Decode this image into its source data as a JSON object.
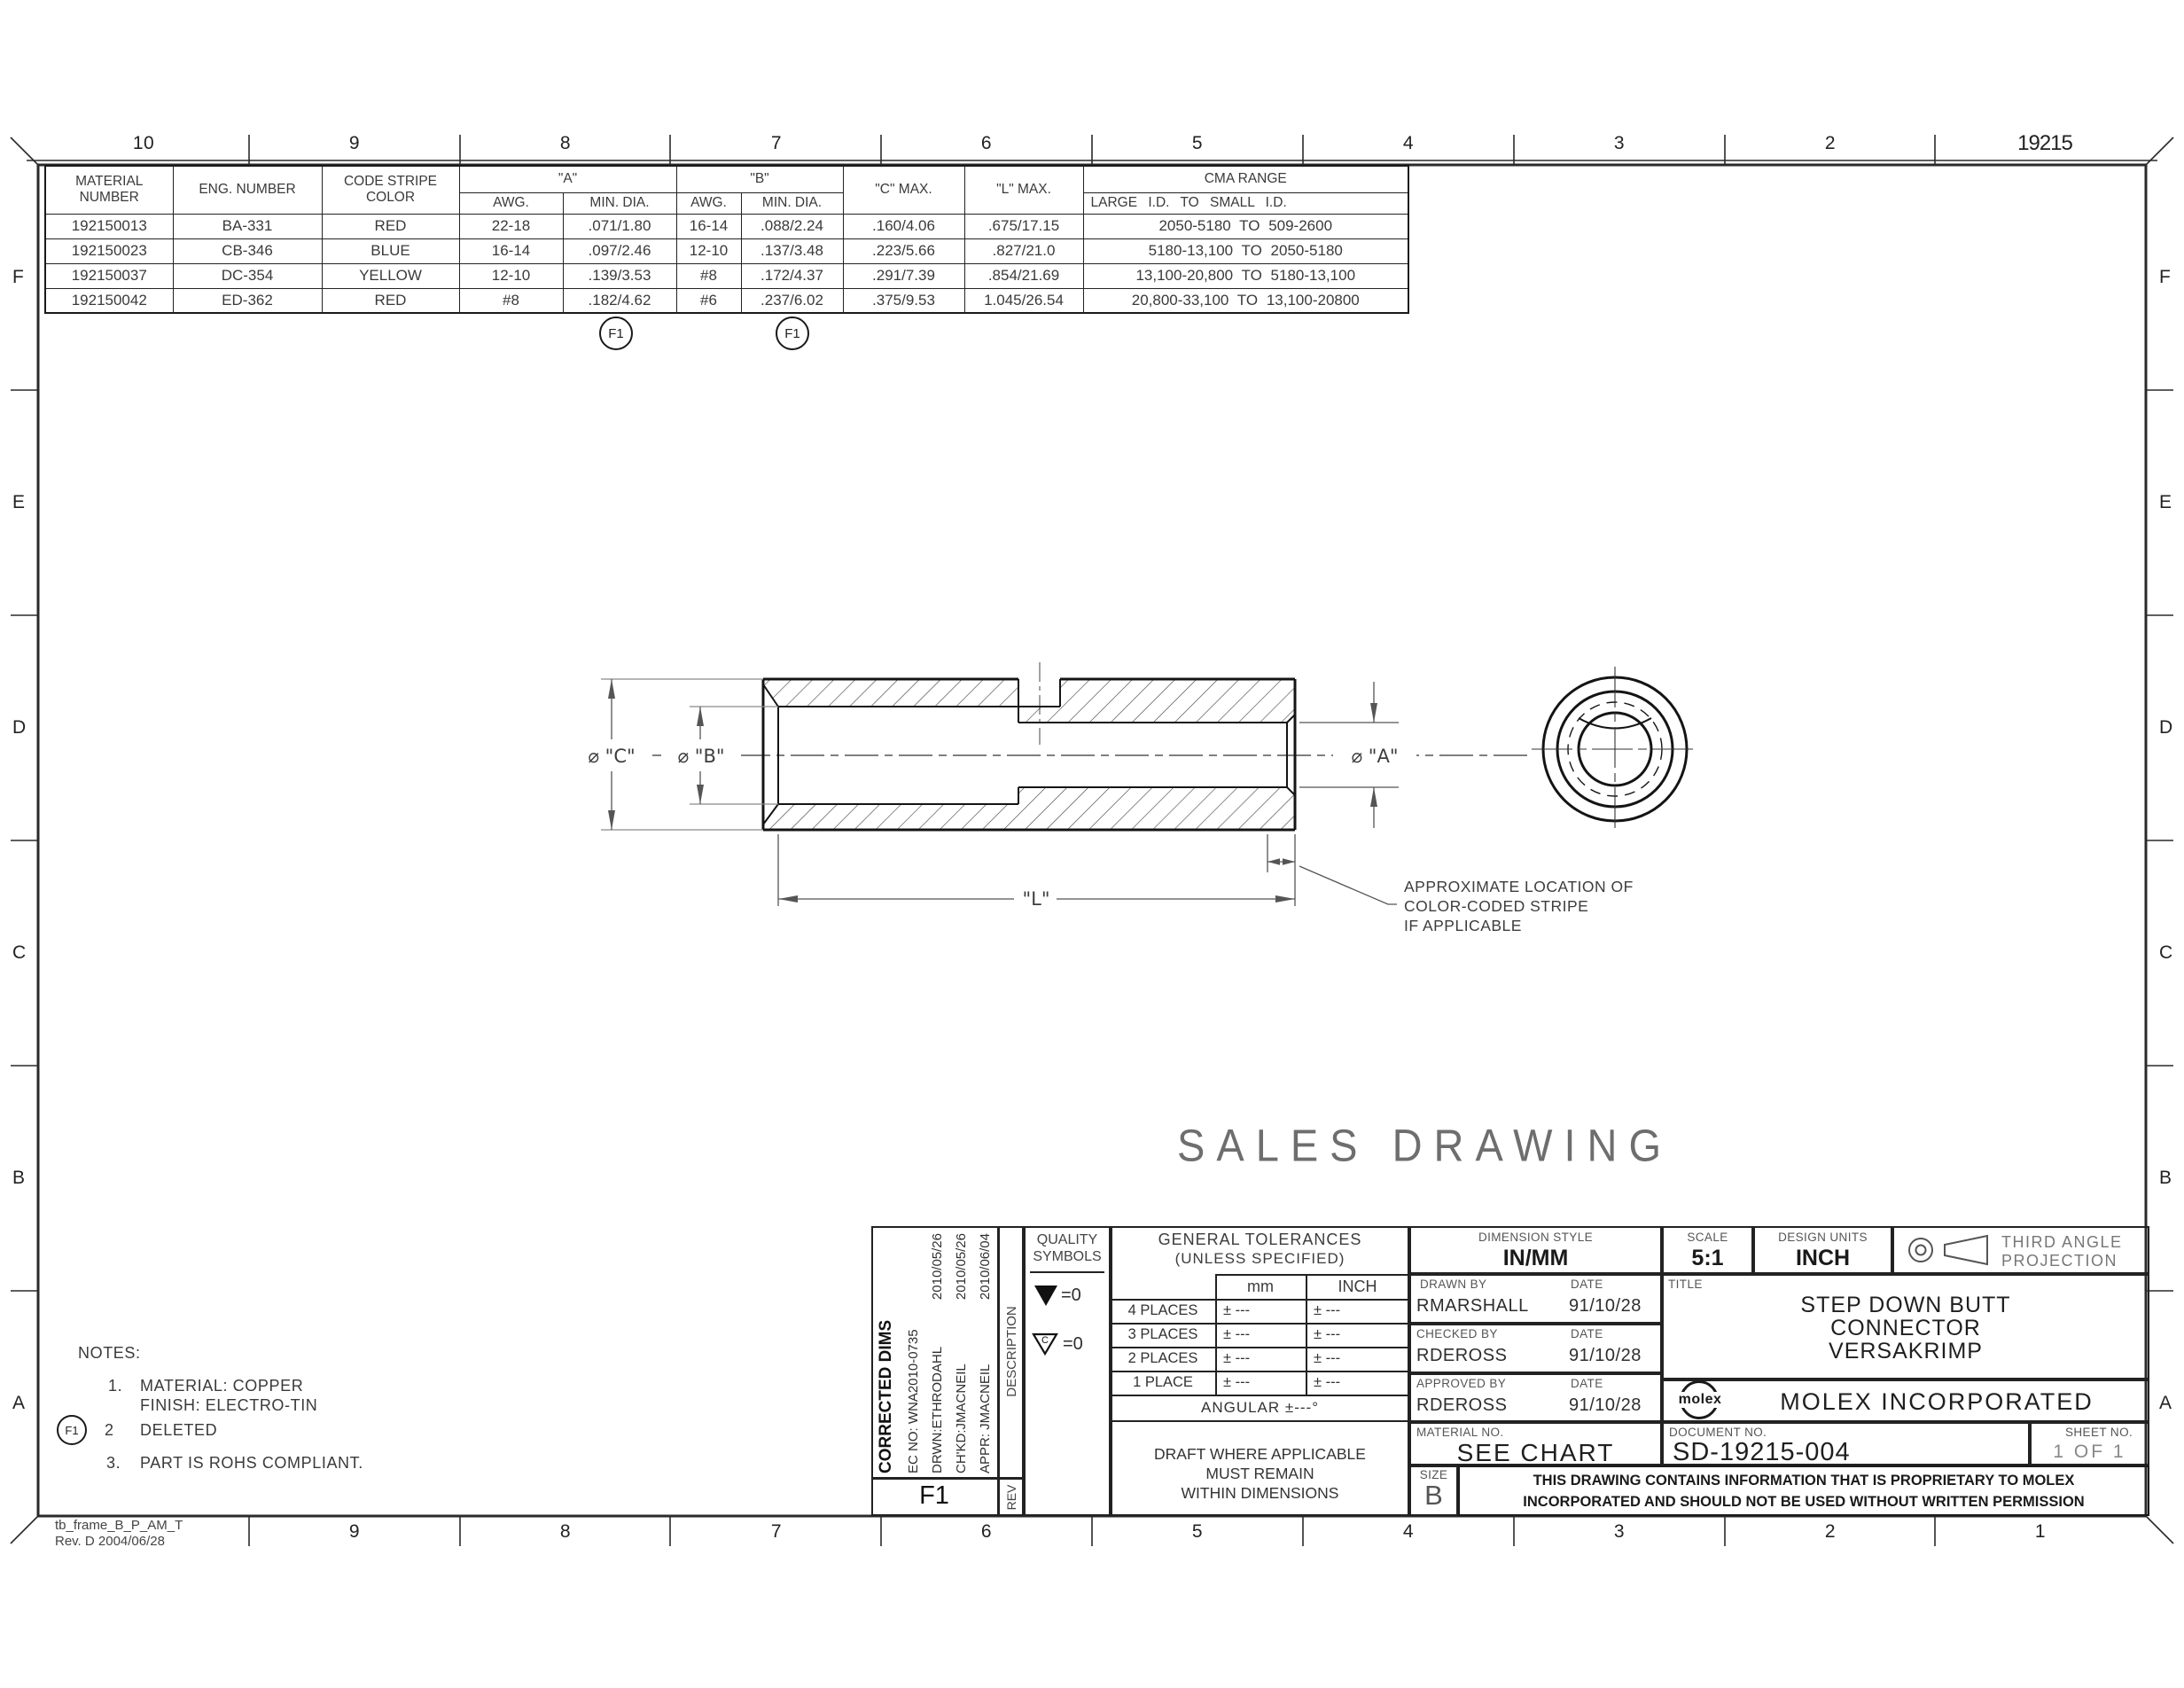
{
  "sheet": {
    "frame_id_line1": "tb_frame_B_P_AM_T",
    "frame_id_line2": "Rev. D 2004/06/28"
  },
  "zones": {
    "top": [
      "10",
      "9",
      "8",
      "7",
      "6",
      "5",
      "4",
      "3",
      "2",
      "19215"
    ],
    "bottom": [
      "9",
      "8",
      "7",
      "6",
      "5",
      "4",
      "3",
      "2",
      "1"
    ],
    "left": [
      "F",
      "E",
      "D",
      "C",
      "B",
      "A"
    ],
    "right": [
      "F",
      "E",
      "D",
      "C",
      "B",
      "A"
    ]
  },
  "spec_table": {
    "headers": {
      "material": "MATERIAL NUMBER",
      "eng": "ENG. NUMBER",
      "stripe": "CODE STRIPE COLOR",
      "a": "\"A\"",
      "b": "\"B\"",
      "awg": "AWG.",
      "min_dia": "MIN. DIA.",
      "c_max": "\"C\" MAX.",
      "l_max": "\"L\" MAX.",
      "cma": "CMA RANGE",
      "cma_sub": "LARGE I.D. TO SMALL I.D."
    },
    "rows": [
      {
        "material": "192150013",
        "eng": "BA-331",
        "stripe": "RED",
        "a_awg": "22-18",
        "a_min": ".071/1.80",
        "b_awg": "16-14",
        "b_min": ".088/2.24",
        "c_max": ".160/4.06",
        "l_max": ".675/17.15",
        "cma": "2050-5180 TO 509-2600"
      },
      {
        "material": "192150023",
        "eng": "CB-346",
        "stripe": "BLUE",
        "a_awg": "16-14",
        "a_min": ".097/2.46",
        "b_awg": "12-10",
        "b_min": ".137/3.48",
        "c_max": ".223/5.66",
        "l_max": ".827/21.0",
        "cma": "5180-13,100 TO 2050-5180"
      },
      {
        "material": "192150037",
        "eng": "DC-354",
        "stripe": "YELLOW",
        "a_awg": "12-10",
        "a_min": ".139/3.53",
        "b_awg": "#8",
        "b_min": ".172/4.37",
        "c_max": ".291/7.39",
        "l_max": ".854/21.69",
        "cma": "13,100-20,800 TO 5180-13,100"
      },
      {
        "material": "192150042",
        "eng": "ED-362",
        "stripe": "RED",
        "a_awg": "#8",
        "a_min": ".182/4.62",
        "b_awg": "#6",
        "b_min": ".237/6.02",
        "c_max": ".375/9.53",
        "l_max": "1.045/26.54",
        "cma": "20,800-33,100 TO 13,100-20800"
      }
    ],
    "flag_a": "F1",
    "flag_b": "F1"
  },
  "drawing": {
    "dim_c": "⌀ \"C\"",
    "dim_b": "⌀ \"B\"",
    "dim_a": "⌀ \"A\"",
    "dim_l": "\"L\"",
    "stripe_note_line1": "APPROXIMATE LOCATION OF",
    "stripe_note_line2": "COLOR-CODED STRIPE",
    "stripe_note_line3": "IF APPLICABLE"
  },
  "watermark": "SALES DRAWING",
  "notes": {
    "title": "NOTES:",
    "n1_num": "1.",
    "n1_line1": "MATERIAL: COPPER",
    "n1_line2": "FINISH: ELECTRO-TIN",
    "n2_flag": "F1",
    "n2_num": "2",
    "n2_text": "DELETED",
    "n3_num": "3.",
    "n3_text": "PART IS ROHS COMPLIANT."
  },
  "revision": {
    "description": "CORRECTED DIMS",
    "ec_no": "EC NO: WNA2010-0735",
    "drwn": "DRWN:ETHRODAHL",
    "drwn_date": "2010/05/26",
    "chkd": "CH'KD:JMACNEIL",
    "chkd_date": "2010/05/26",
    "appr": "APPR: JMACNEIL",
    "appr_date": "2010/06/04",
    "rev": "F1",
    "col_description": "DESCRIPTION",
    "col_rev": "REV"
  },
  "quality": {
    "title_line1": "QUALITY",
    "title_line2": "SYMBOLS",
    "sym1_value": "=0",
    "sym2_letter": "C",
    "sym2_value": "=0"
  },
  "tolerances": {
    "title_line1": "GENERAL TOLERANCES",
    "title_line2": "(UNLESS SPECIFIED)",
    "col_mm": "mm",
    "col_inch": "INCH",
    "rows": [
      {
        "label": "4 PLACES",
        "mm": "± ---",
        "inch": "± ---"
      },
      {
        "label": "3 PLACES",
        "mm": "± ---",
        "inch": "± ---"
      },
      {
        "label": "2 PLACES",
        "mm": "± ---",
        "inch": "± ---"
      },
      {
        "label": "1 PLACE",
        "mm": "± ---",
        "inch": "± ---"
      }
    ],
    "angular": "ANGULAR ±---°",
    "draft_line1": "DRAFT WHERE APPLICABLE",
    "draft_line2": "MUST REMAIN",
    "draft_line3": "WITHIN DIMENSIONS"
  },
  "title_block": {
    "dimension_style_label": "DIMENSION STYLE",
    "dimension_style": "IN/MM",
    "scale_label": "SCALE",
    "scale": "5:1",
    "design_units_label": "DESIGN UNITS",
    "design_units": "INCH",
    "projection_line1": "THIRD ANGLE",
    "projection_line2": "PROJECTION",
    "drawn_by_label": "DRAWN BY",
    "date_label": "DATE",
    "drawn_by": "RMARSHALL",
    "drawn_date": "91/10/28",
    "checked_by_label": "CHECKED BY",
    "checked_by": "RDEROSS",
    "checked_date": "91/10/28",
    "approved_by_label": "APPROVED BY",
    "approved_by": "RDEROSS",
    "approved_date": "91/10/28",
    "title_label": "TITLE",
    "title_line1": "STEP DOWN BUTT",
    "title_line2": "CONNECTOR",
    "title_line3": "VERSAKRIMP",
    "company_logo": "molex",
    "company": "MOLEX INCORPORATED",
    "material_no_label": "MATERIAL NO.",
    "material_no": "SEE CHART",
    "document_no_label": "DOCUMENT NO.",
    "document_no": "SD-19215-004",
    "sheet_no_label": "SHEET NO.",
    "sheet_no": "1 OF 1",
    "size_label": "SIZE",
    "size": "B",
    "proprietary_line1": "THIS DRAWING CONTAINS INFORMATION THAT IS PROPRIETARY TO MOLEX",
    "proprietary_line2": "INCORPORATED AND SHOULD NOT BE USED WITHOUT WRITTEN PERMISSION"
  }
}
